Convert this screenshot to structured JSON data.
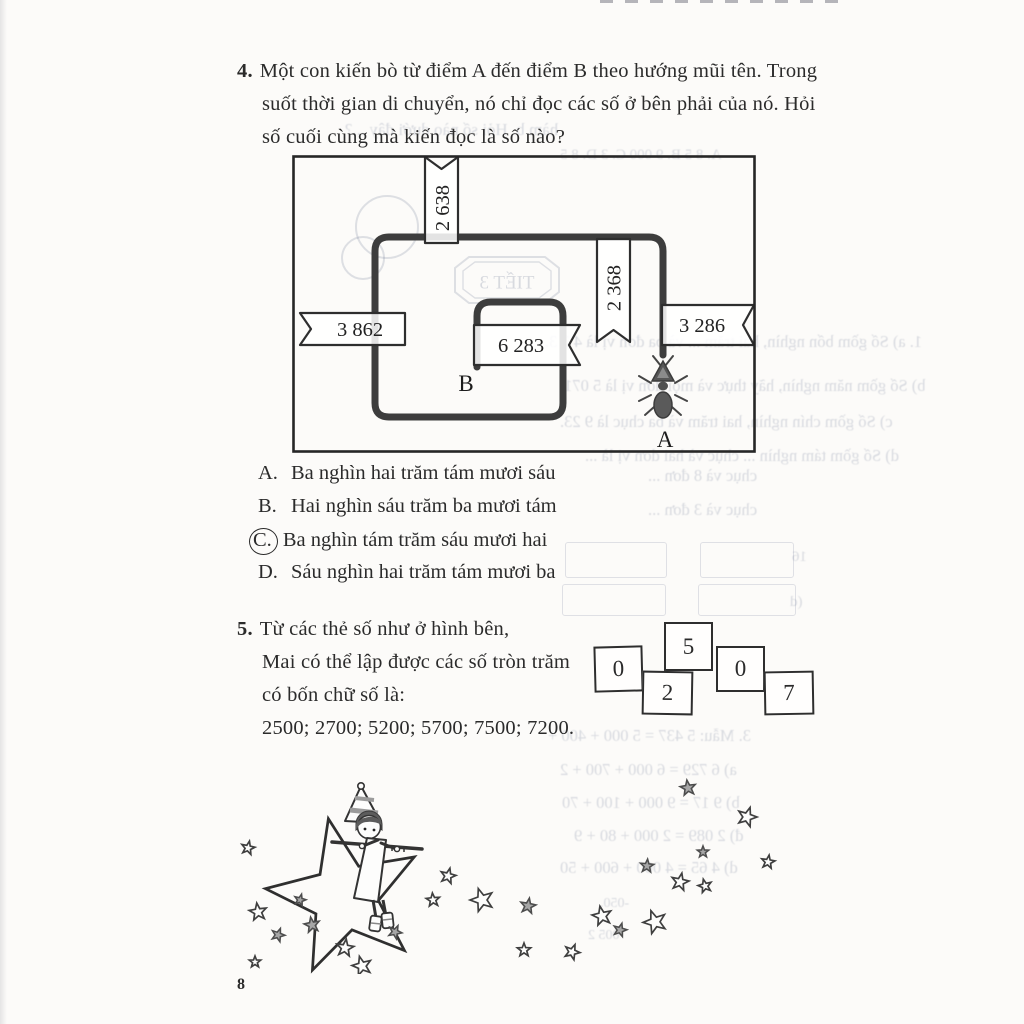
{
  "page": {
    "number": "8"
  },
  "colors": {
    "ink": "#2b2b2b",
    "path": "#3d3d3d",
    "paper": "#fcfbf9",
    "bleed": "#7a86a8"
  },
  "problem4": {
    "number": "4.",
    "lines": [
      "Một con kiến bò từ điểm A đến điểm B theo hướng mũi tên. Trong",
      "suốt thời gian di chuyển, nó chỉ đọc các số ở bên phải của nó. Hỏi",
      "số cuối cùng mà kiến đọc là số nào?"
    ],
    "diagram": {
      "flags": [
        {
          "id": "flag-top",
          "value": "2 638"
        },
        {
          "id": "flag-upper-right",
          "value": "2 368"
        },
        {
          "id": "flag-left",
          "value": "3 862"
        },
        {
          "id": "flag-right",
          "value": "3 286"
        },
        {
          "id": "flag-inner",
          "value": "6 283"
        }
      ],
      "point_start": "A",
      "point_end": "B"
    },
    "options": [
      {
        "key": "A.",
        "text": "Ba nghìn hai trăm tám mươi sáu",
        "circled": false
      },
      {
        "key": "B.",
        "text": "Hai nghìn sáu trăm ba mươi tám",
        "circled": false
      },
      {
        "key": "C.",
        "text": "Ba nghìn tám trăm sáu mươi hai",
        "circled": true
      },
      {
        "key": "D.",
        "text": "Sáu nghìn hai trăm tám mươi ba",
        "circled": false
      }
    ]
  },
  "problem5": {
    "number": "5.",
    "lines": [
      "Từ các thẻ số như ở hình bên,",
      "Mai có thể lập được các số tròn trăm",
      "có bốn chữ số là:",
      "2500; 2700; 5200; 5700; 7500; 7200."
    ],
    "cards": [
      "0",
      "5",
      "2",
      "0",
      "7"
    ]
  },
  "bleedthrough": {
    "fragments": [
      "hàm b. Hỏi số nào dưới đây ...?",
      "A. 8 5      B. 9 000      C. 3      D. 8 5",
      "TIẾT 3",
      "1. a) Số gồm bốn nghìn, hai trăm ... và ba đơn vị là 4 2 3.",
      "b) Số gồm năm nghìn, hãy thực và mọi đơn vị là 5 071.",
      "c) Số gồm chín nghìn, hai trăm và ba chục là 9 23.",
      "d) Số gồm tám nghìn ... chục và hai đơn vị là ...",
      "chục và 8 đơn ...",
      "chục và 3 đơn ...",
      "16",
      "(d",
      "3. Mẫu: 5 437 = 5 000 + 400 +",
      "a) 6 729 = 6 000 + 700 + 2",
      "b) 9 17 = 9 000 + 100 + 70",
      "đ) 2 089 = 2 000 + 80 + 9",
      "d) 4 65 = 4 000 + 600 + 50",
      "-050.",
      "005 2"
    ]
  }
}
